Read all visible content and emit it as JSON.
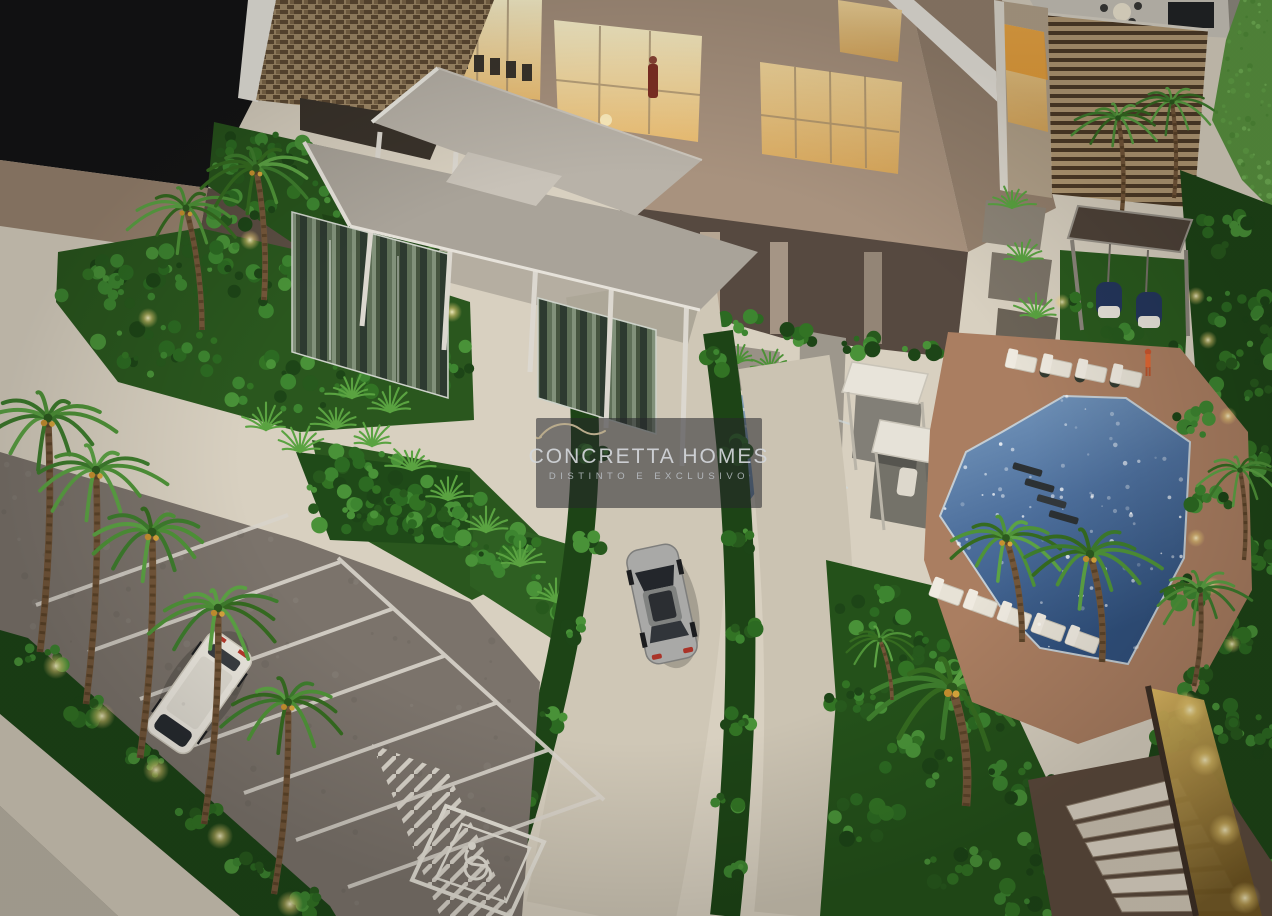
{
  "image": {
    "kind": "photograph",
    "subject": "Aerial dusk photo of an illuminated architectural scale model of a residential condominium",
    "view": "high-angle aerial"
  },
  "watermark": {
    "icon": "roofline-logo-icon",
    "brand": "CONCRETTA HOMES",
    "tagline": "DISTINTO E EXCLUSIVO"
  },
  "scene": {
    "elements": [
      "residential tower facade with warm lit interiors and figurine",
      "flat grey entrance porte-cochere canopy on slender columns",
      "mirror-glass lobby walls reflecting plants",
      "curved beige driveway with silver sedan",
      "parking lot with white minivan and white stall markings",
      "accessible parking space with wheelchair pictogram",
      "hatched no-parking zone",
      "row of uplit palm trees along hedge strip",
      "blue tiled water feature beside driveway",
      "two white cabana frames",
      "L-shaped swimming pool with in-pool loungers and sparkling water",
      "white sun loungers with dark planters",
      "red-swimsuit figurine at pool edge",
      "wood slat privacy screen wall",
      "pergola with two navy hanging swing chairs",
      "terraced concrete planters",
      "rooftop terrace with round table and chairs",
      "garden staircase between brown walls",
      "amber-lit garden path",
      "bright lawn strip",
      "dense dark hedges"
    ]
  },
  "palette": {
    "plaza": "#d8d0c0",
    "asphalt": "#7b736b",
    "canopy": "#a9a399",
    "facade": "#a8927e",
    "window_glow": "#f6dfa2",
    "hedge": "#1e4517",
    "foliage": "#3e7d2d",
    "pool": "#44618e",
    "deck": "#aa7e61",
    "trunk": "#74573a",
    "marking": "#dcd7ce",
    "gold_path": "#c8a84b",
    "watermark_bg": "rgba(38,39,43,0.55)",
    "watermark_text": "#d4d7db"
  }
}
